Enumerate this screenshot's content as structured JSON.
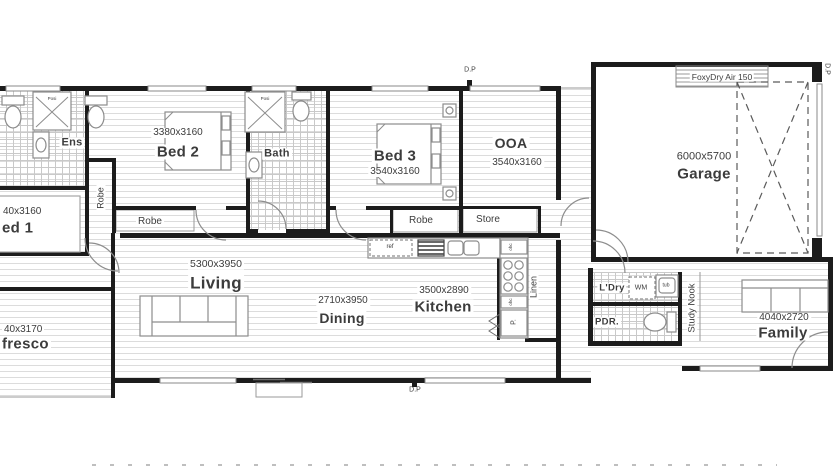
{
  "title": "house-floor-plan",
  "rooms": {
    "ens": {
      "name": "Ens"
    },
    "bed1": {
      "name": "ed 1",
      "dims": "40x3160"
    },
    "bed2": {
      "name": "Bed 2",
      "dims": "3380x3160"
    },
    "bath": {
      "name": "Bath"
    },
    "bed3": {
      "name": "Bed 3",
      "dims": "3540x3160"
    },
    "ooa": {
      "name": "OOA",
      "dims": "3540x3160"
    },
    "garage": {
      "name": "Garage",
      "dims": "6000x5700"
    },
    "living": {
      "name": "Living",
      "dims": "5300x3950"
    },
    "dining": {
      "name": "Dining",
      "dims": "2710x3950"
    },
    "kitchen": {
      "name": "Kitchen",
      "dims": "3500x2890"
    },
    "family": {
      "name": "Family",
      "dims": "4040x2720"
    },
    "alfresco": {
      "name": "fresco",
      "dims": "40x3170"
    },
    "laundry": {
      "name": "L'Dry"
    },
    "powder": {
      "name": "PDR."
    },
    "linen": {
      "name": "Linen"
    },
    "study_nook": {
      "name": "Study Nook"
    },
    "robe": {
      "name": "Robe"
    },
    "store": {
      "name": "Store"
    }
  },
  "annotations": {
    "foxydry": "FoxyDry Air 150",
    "downpipe": "D.P",
    "washing_machine": "WM",
    "tub": "tub",
    "fridge": "ref",
    "overhead_cupboard": "ohc",
    "pantry": "P.",
    "shower": "Posi"
  },
  "colors": {
    "wall": "#1c1c1c",
    "fixture_line": "#8d8d8d",
    "board_line": "#dcdcdc",
    "tile_line": "#c9c9c9",
    "dash": "#5a5a5a",
    "text": "#3c3c3c"
  }
}
